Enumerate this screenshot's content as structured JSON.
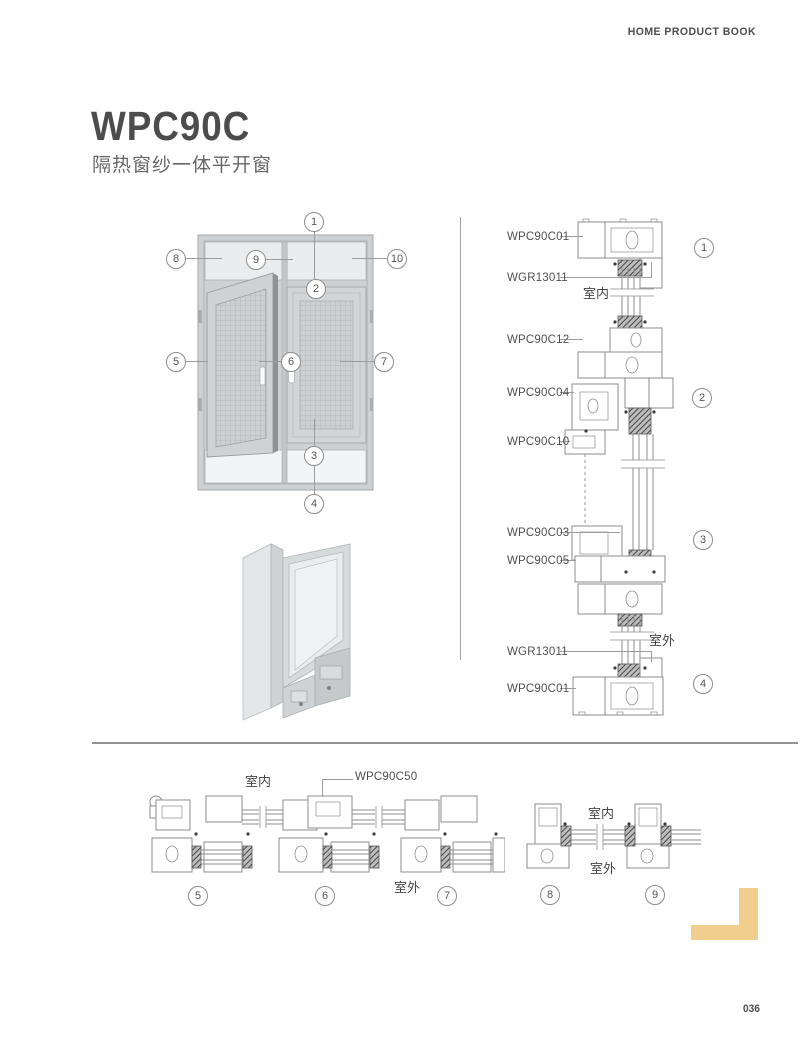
{
  "header": {
    "book_title": "HOME PRODUCT BOOK"
  },
  "title": {
    "model": "WPC90C",
    "subtitle": "隔热窗纱一体平开窗"
  },
  "callout_numbers": {
    "n1": "1",
    "n2": "2",
    "n3": "3",
    "n4": "4",
    "n5": "5",
    "n6": "6",
    "n7": "7",
    "n8": "8",
    "n9": "9",
    "n10": "10"
  },
  "vertical_sections": {
    "labels": [
      "WPC90C01",
      "WGR13011",
      "WPC90C12",
      "WPC90C04",
      "WPC90C10",
      "WPC90C03",
      "WPC90C05",
      "WGR13011",
      "WPC90C01"
    ],
    "interior_label": "室内",
    "exterior_label": "室外"
  },
  "horizontal_sections": {
    "left": {
      "interior_label": "室内",
      "part_label": "WPC90C50",
      "exterior_label": "室外"
    },
    "right": {
      "interior_label": "室内",
      "exterior_label": "室外"
    }
  },
  "footer": {
    "page_number": "036"
  },
  "colors": {
    "accent_tan": "#F1CE8D",
    "text_dark": "#4A4A4A",
    "line_gray": "#9C9C9C"
  }
}
